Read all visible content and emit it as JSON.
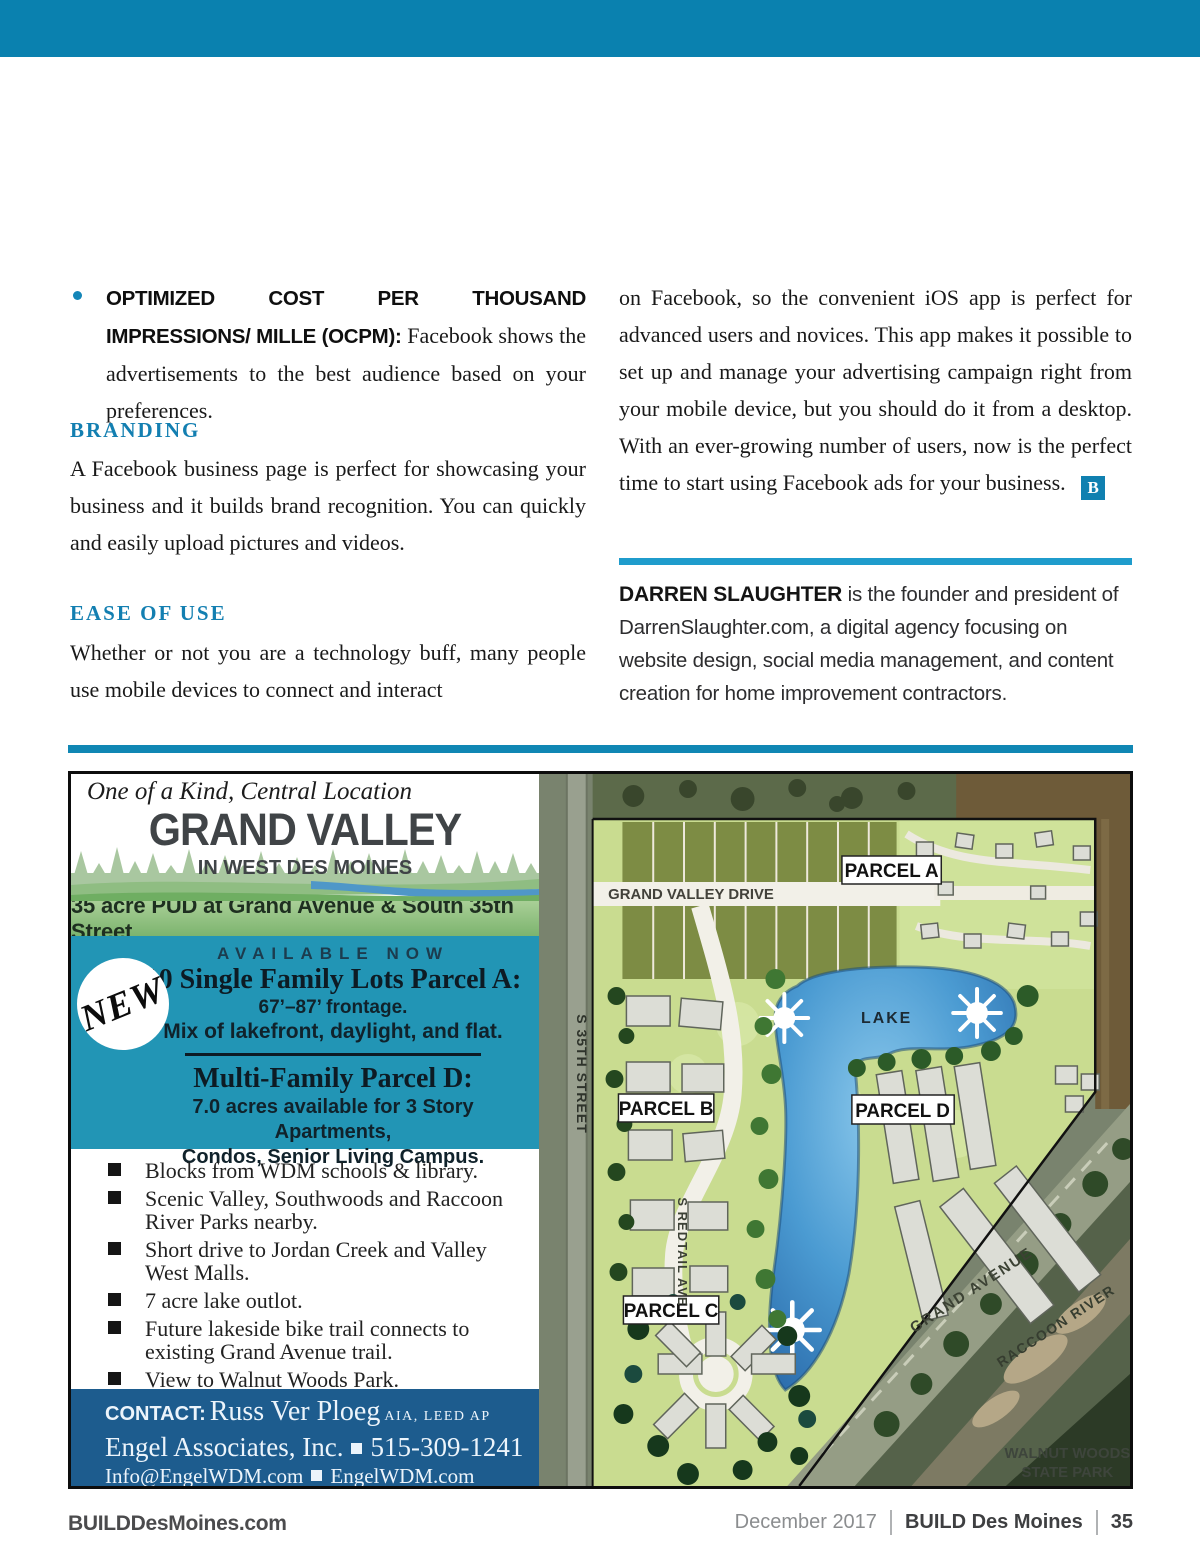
{
  "colors": {
    "topbar_blue": "#0a81af",
    "heading_blue": "#137fb1",
    "rule_blue": "#1f9ccc",
    "ad_teal": "#2295b5",
    "ad_green_band": "#8abc7d",
    "contact_blue": "#1d5c8e",
    "lake_blue": "#4b9bd2"
  },
  "article": {
    "bullet_item": {
      "lead": "OPTIMIZED COST PER THOUSAND IMPRESSIONS/ MILLE (OCPM):",
      "rest": "Facebook shows the advertisements to the best audience based on your preferences."
    },
    "branding_heading": "BRANDING",
    "branding_body": "A Facebook business page is perfect for showcasing your business and it builds brand recognition. You can quickly and easily upload pictures and videos.",
    "ease_heading": "EASE OF USE",
    "ease_body": "Whether or not you are a technology buff, many people use mobile devices to connect and interact",
    "right_column_body": "on Facebook, so the convenient iOS app is perfect for advanced users and novices. This app makes it possible to set up and manage your advertising campaign right from your mobile device, but you should do it from a desktop. With an ever-growing number of users, now is the perfect time to start using Facebook ads for your business.",
    "end_mark": "B",
    "bio_name": "DARREN SLAUGHTER",
    "bio_text": "is the founder and president of DarrenSlaughter.com, a digital agency focusing on website design, social media management, and content creation for home improvement contractors."
  },
  "ad": {
    "tagline": "One of a Kind, Central Location",
    "title": "GRAND VALLEY",
    "subtitle": "IN WEST DES MOINES",
    "location_line": "35 acre PUD at Grand Avenue & South 35th Street",
    "badge": "NEW",
    "offer": {
      "available": "AVAILABLE NOW",
      "parcel_a_title": "10 Single Family Lots Parcel A:",
      "parcel_a_line1": "67’–87’ frontage.",
      "parcel_a_line2": "Mix of lakefront, daylight, and flat.",
      "parcel_d_title": "Multi-Family Parcel D:",
      "parcel_d_line1": "7.0 acres available for 3 Story Apartments,",
      "parcel_d_line2": "Condos,  Senior Living Campus."
    },
    "features": [
      "Blocks from WDM schools & library.",
      "Scenic Valley, Southwoods and Raccoon River Parks nearby.",
      "Short drive to Jordan Creek and Valley West Malls.",
      "7 acre lake outlot.",
      "Future lakeside bike trail connects to existing Grand Avenue trail.",
      "View to Walnut Woods Park."
    ],
    "contact": {
      "label": "CONTACT:",
      "name": "Russ Ver Ploeg",
      "credentials": "AIA, LEED AP",
      "company": "Engel Associates, Inc.",
      "phone": "515-309-1241",
      "email": "Info@EngelWDM.com",
      "website": "EngelWDM.com"
    },
    "map_labels": {
      "grand_valley_drive": "GRAND VALLEY DRIVE",
      "parcel_a": "PARCEL A",
      "lake": "LAKE",
      "parcel_b": "PARCEL B",
      "parcel_d": "PARCEL D",
      "parcel_c": "PARCEL C",
      "street_35th": "S 35TH STREET",
      "street_redtail": "S REDTAIL AVE",
      "grand_avenue": "GRAND AVENUE",
      "raccoon_river": "RACCOON RIVER",
      "walnut_woods_line1": "WALNUT WOODS",
      "walnut_woods_line2": "STATE PARK"
    }
  },
  "footer": {
    "site": "BUILDDesMoines.com",
    "issue": "December 2017",
    "magazine": "BUILD Des Moines",
    "page_number": "35"
  }
}
